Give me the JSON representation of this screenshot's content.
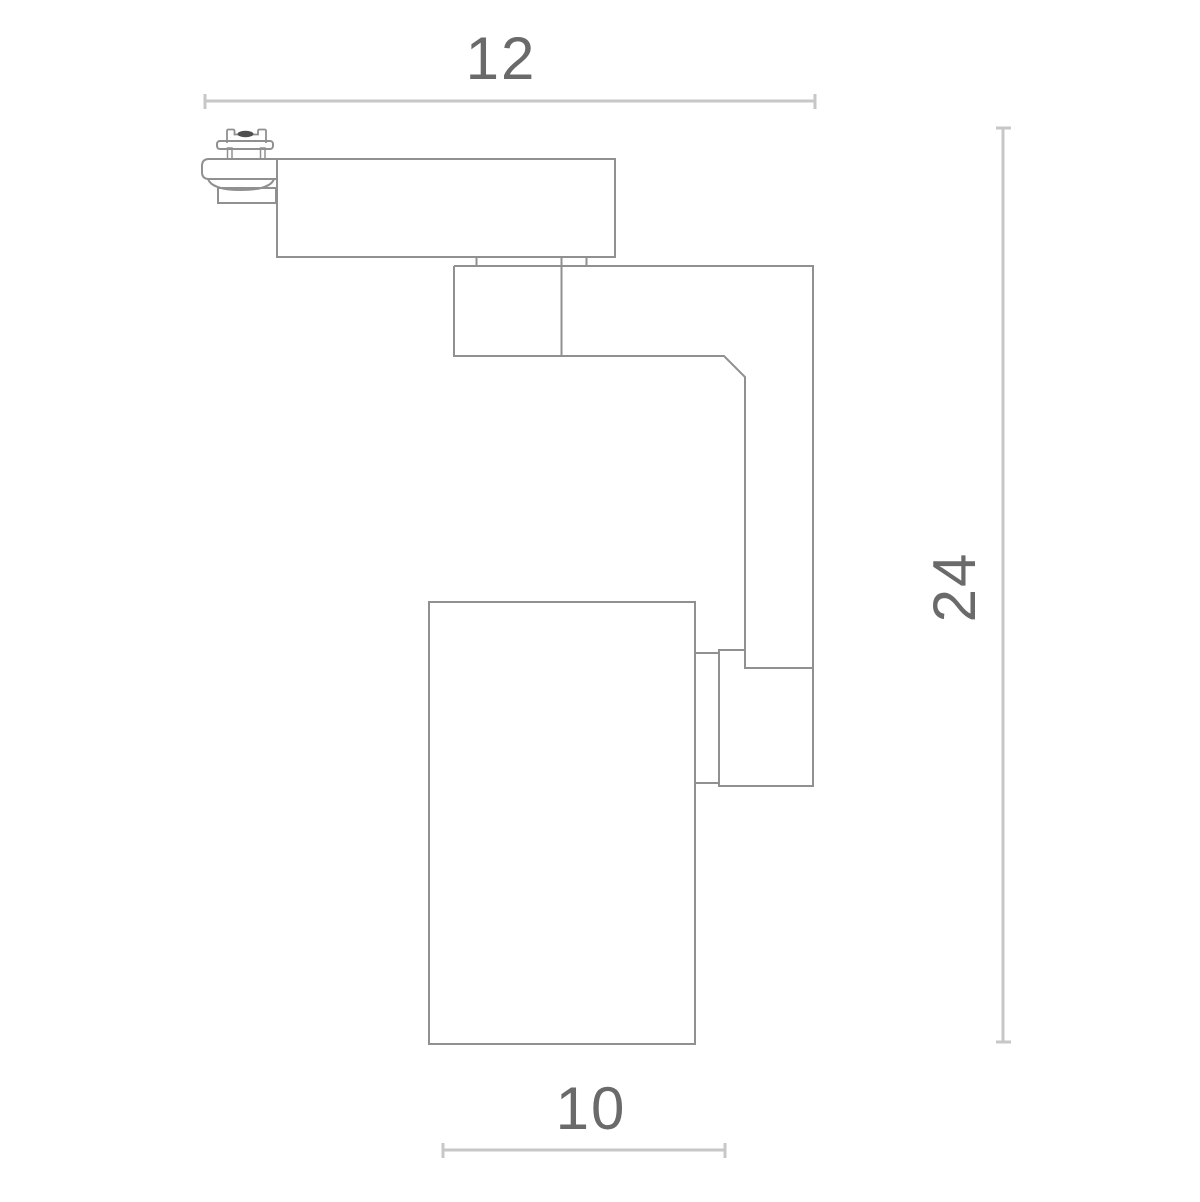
{
  "drawing": {
    "dimensions": {
      "overall_width": "12",
      "overall_height": "24",
      "body_width": "10"
    }
  },
  "colors": {
    "background": "#ffffff",
    "part_outline": "#909090",
    "dimension_line": "#c7c7c7",
    "label_text": "#6a6a6a",
    "screw_fill": "#4f4f4f"
  }
}
